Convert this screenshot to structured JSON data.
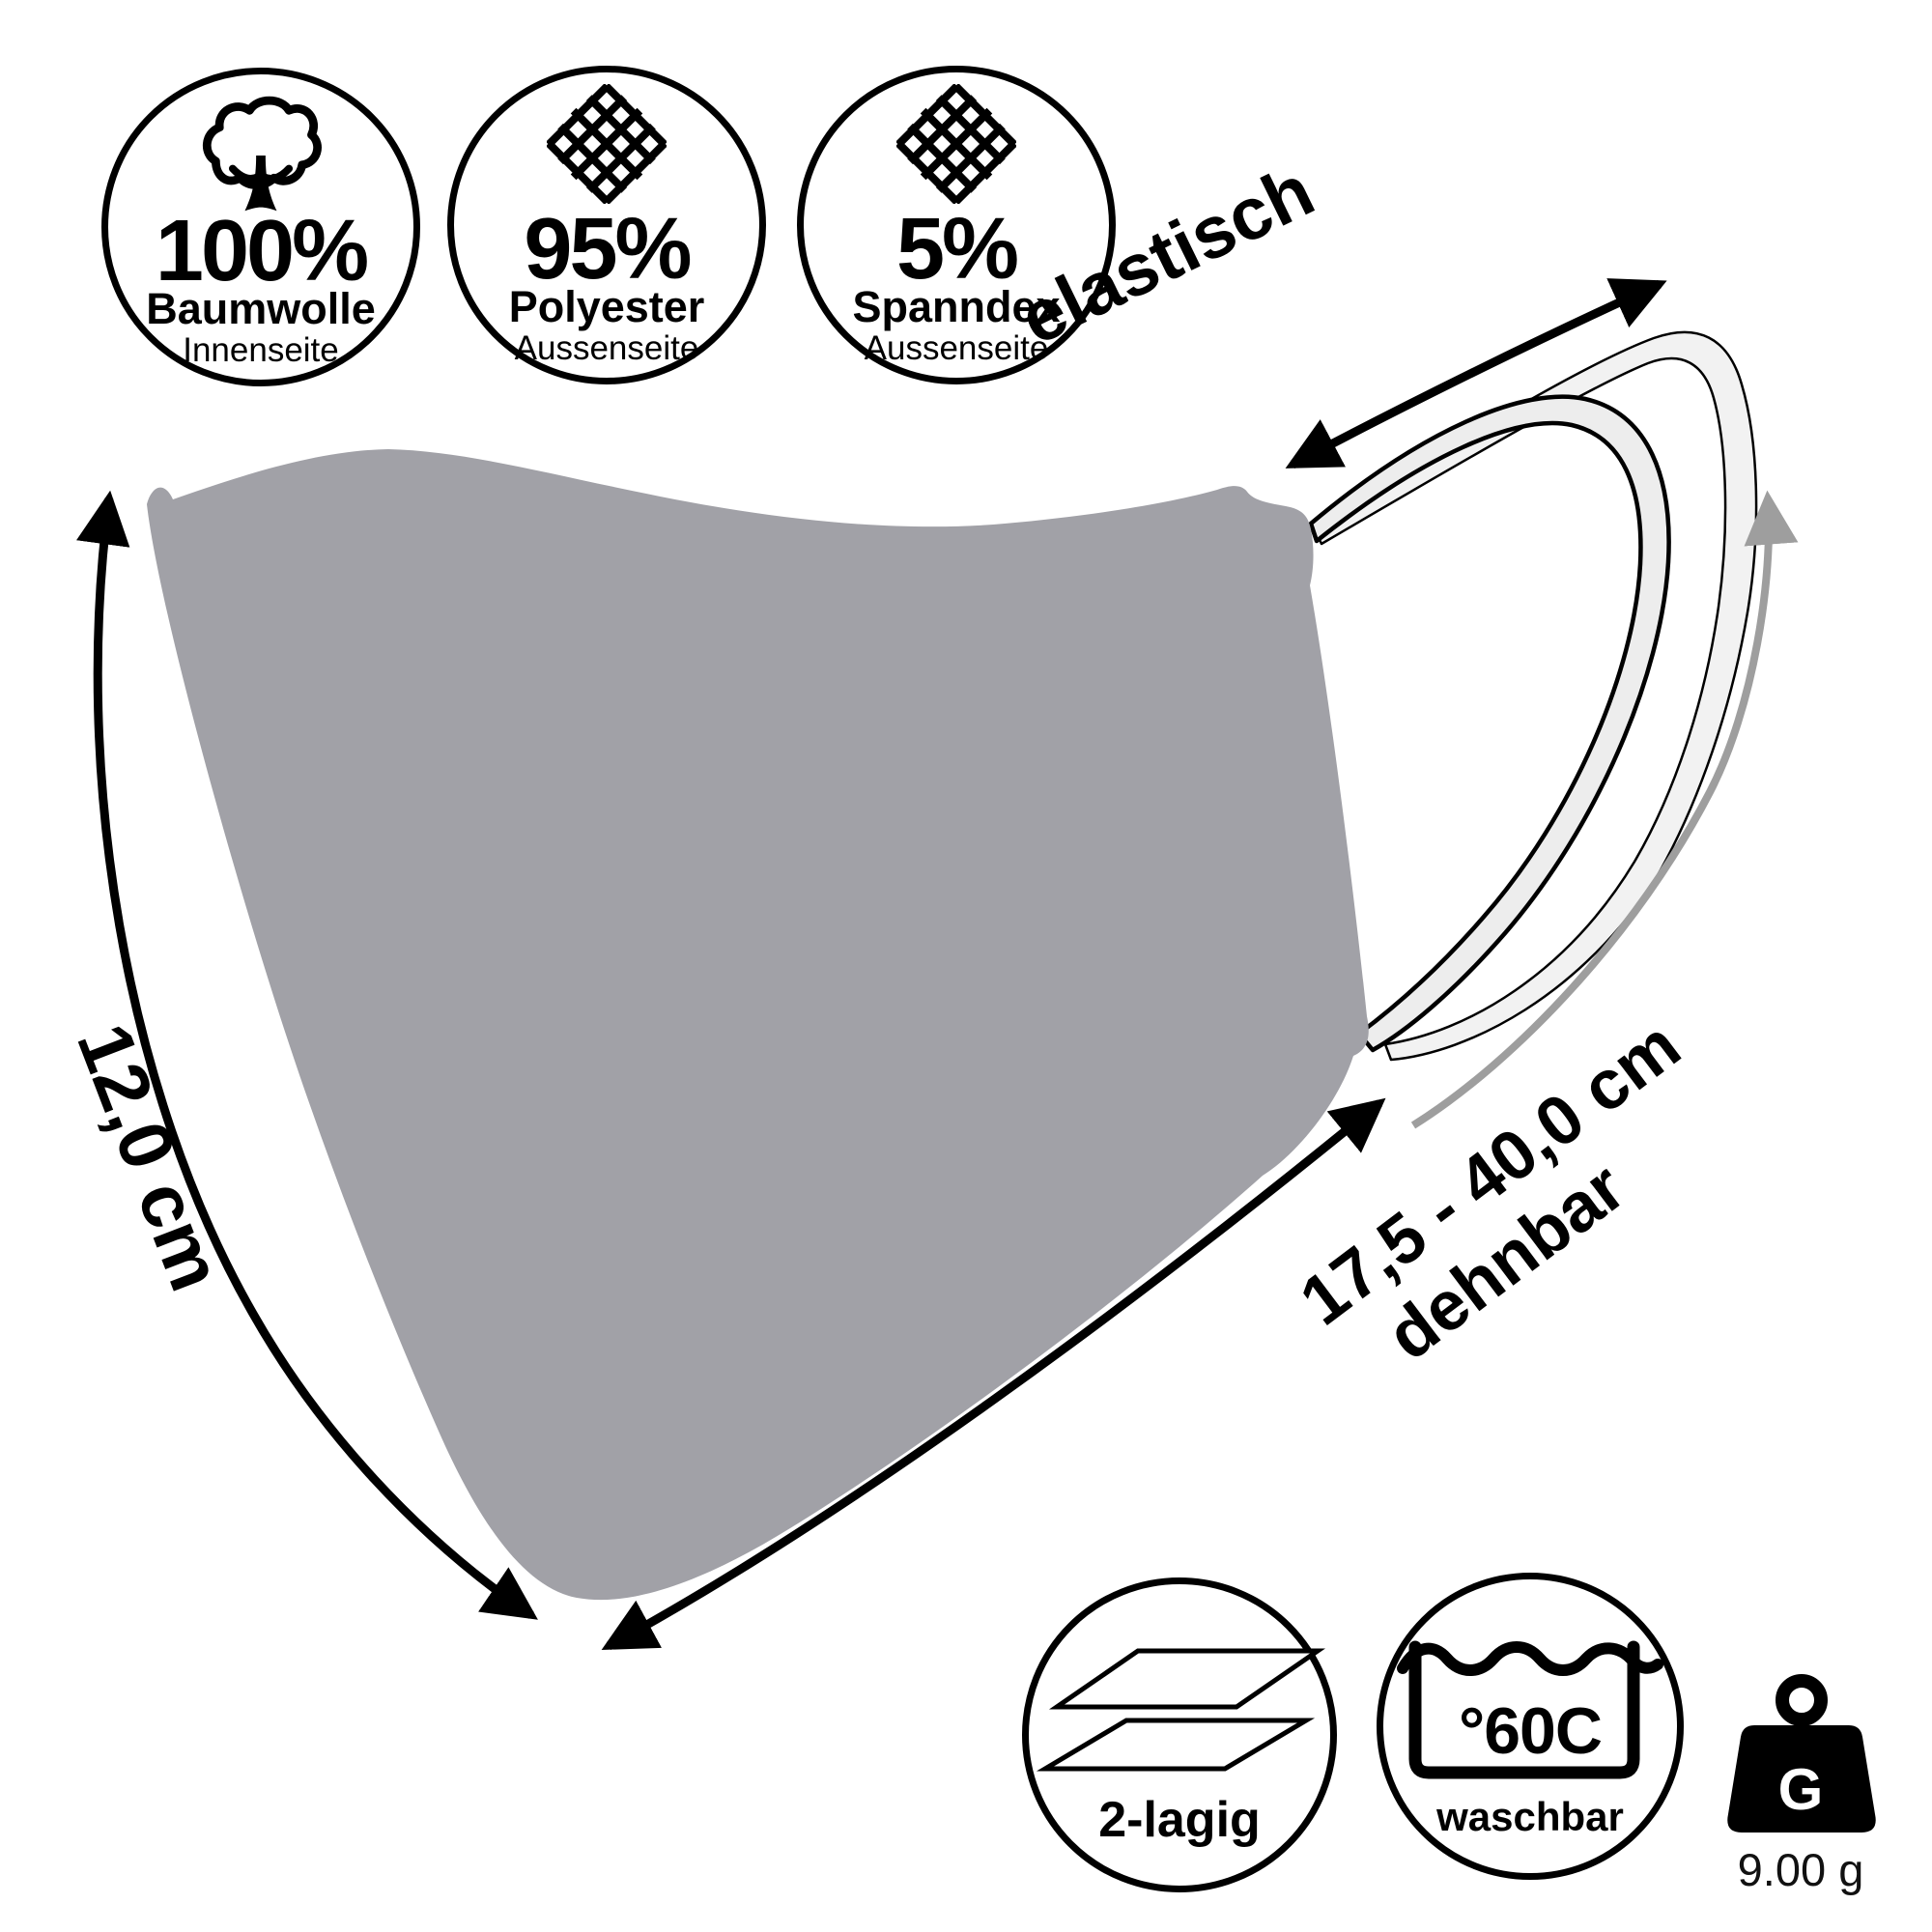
{
  "page": {
    "background": "#ffffff"
  },
  "colors": {
    "mask": "#a1a1a7",
    "loop_fill": "#ededed",
    "loop_fill_outer": "#f2f2f2",
    "outline": "#000000",
    "dimension_gray": "#9e9e9e"
  },
  "material_badges": [
    {
      "icon": "cotton-icon",
      "value": "100%",
      "material": "Baumwolle",
      "side": "Innenseite"
    },
    {
      "icon": "mesh-icon",
      "value": "95%",
      "material": "Polyester",
      "side": "Aussenseite"
    },
    {
      "icon": "mesh-icon",
      "value": "5%",
      "material": "Spanndex",
      "side": "Aussenseite"
    }
  ],
  "annotations": {
    "elastic_label": "elastisch",
    "height_label": "12,0 cm",
    "stretch_label": "17,5 - 40,0 cm",
    "stretch_sublabel": "dehnbar"
  },
  "feature_badges": {
    "layers_label": "2-lagig",
    "wash_temp": "°60C",
    "wash_label": "waschbar"
  },
  "weight": {
    "letter": "G",
    "value": "9.00 g"
  }
}
